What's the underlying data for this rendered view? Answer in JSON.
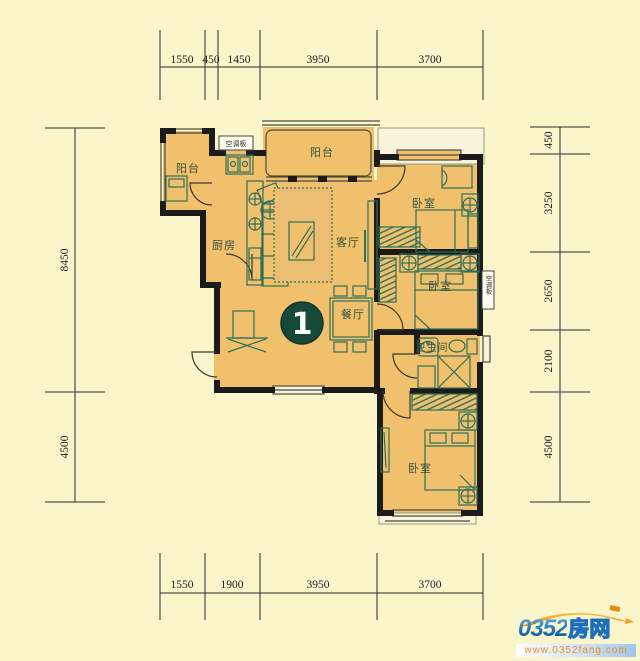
{
  "unit": {
    "number": "1"
  },
  "rooms": {
    "balcony_left": "阳台",
    "balcony_top": "阳台",
    "kitchen": "厨房",
    "living_room": "客厅",
    "dining_room": "餐厅",
    "bedroom_top": "卧室",
    "bedroom_middle": "卧室",
    "bedroom_bottom": "卧室",
    "bathroom": "卫生间",
    "ac_panel_top": "空调板",
    "ac_panel_right": "空调板"
  },
  "dimensions": {
    "top": [
      "1550",
      "450",
      "1450",
      "3950",
      "3700"
    ],
    "bottom": [
      "1550",
      "1900",
      "3950",
      "3700"
    ],
    "left": [
      "8450",
      "4500"
    ],
    "right": [
      "450",
      "3250",
      "2650",
      "2100",
      "4500"
    ]
  },
  "watermark": {
    "brand_number": "0352",
    "brand_name": "房网",
    "url": "www.0352fang.com"
  },
  "colors": {
    "background": "#FBF5CC",
    "floor": "#F1C06C",
    "bay": "#FAF3DB",
    "wall": "#1B1B1B",
    "furniture": "#2E6F58",
    "label": "#32523F",
    "unit_badge": "#17493A",
    "brand_blue": "#1B6FBE",
    "brand_orange": "#F08C1E"
  }
}
